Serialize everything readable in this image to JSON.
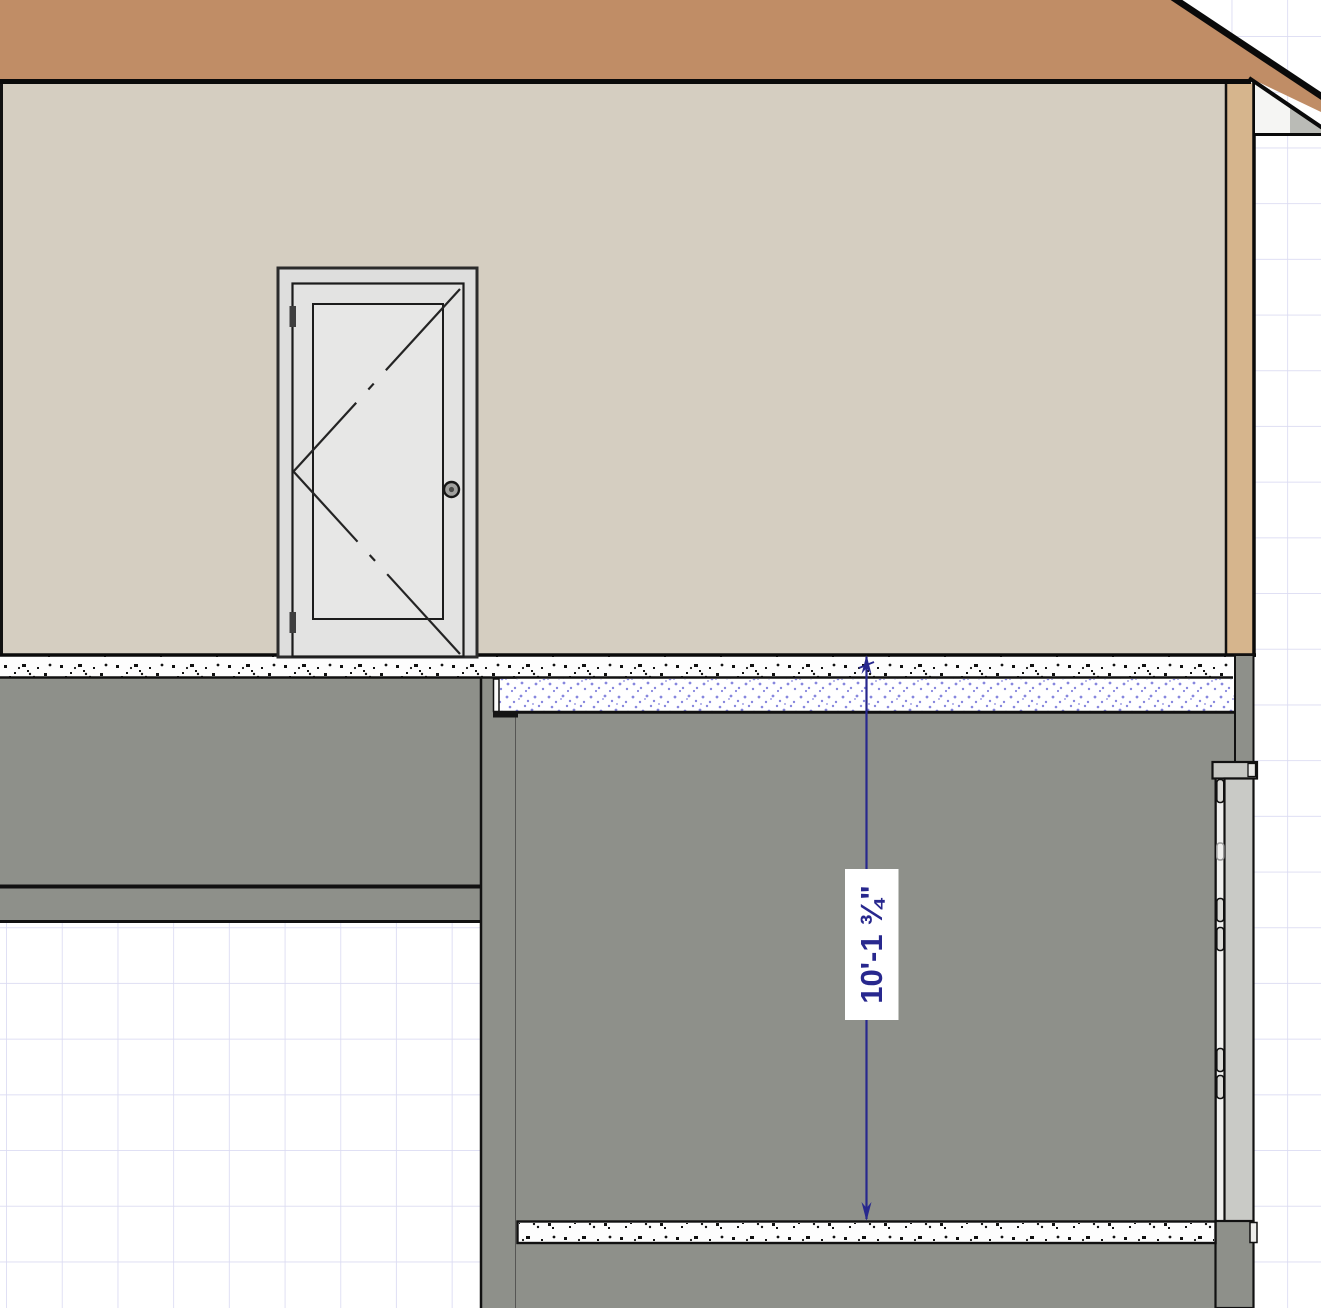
{
  "canvas": {
    "view": "cross-section-elevation",
    "dimension": {
      "label": "10'-1 ¾\"",
      "color": "#28288e"
    },
    "grid": {
      "line_color": "#dbdbf2",
      "bg_color": "#ffffff"
    },
    "colors": {
      "roof": "#c08d66",
      "roof_edge": "#0a0a0a",
      "wall_beige": "#d5cec1",
      "corner_trim": "#d6b58d",
      "wall_gray": "#8e908a",
      "soffit_white": "#f5f5f3",
      "fascia_gray": "#babbb6",
      "band_white": "#fdfdfd",
      "speckle_black": "#111111",
      "speckle_blue": "#8787de",
      "door_frame": "#dededd",
      "door_face": "#e3e3e2",
      "door_panel": "#e7e7e6",
      "door_hardware": "#3f3f3f",
      "section_door": "#c9cac6",
      "section_jamb": "#f0f0ee",
      "header_cap": "#c6c7c3",
      "step_black": "#141414"
    }
  }
}
